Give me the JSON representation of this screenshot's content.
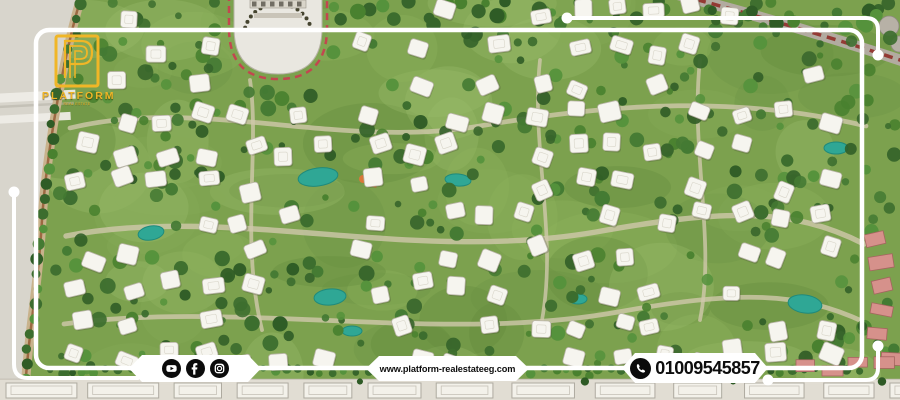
{
  "brand": {
    "name": "PLATFORM",
    "tagline": "REAL ESTATE"
  },
  "footer": {
    "social": {
      "youtube": "YouTube",
      "facebook": "Facebook",
      "instagram": "Instagram"
    },
    "website": {
      "url": "www.platform-realestateeg.com"
    },
    "contact": {
      "phone": "01009545857",
      "icon": "whatsapp"
    }
  },
  "scene": {
    "seed": 11,
    "colors": {
      "base": "#7ca14e",
      "mottle": [
        "#8fb45e",
        "#6a9344",
        "#9dbd6d",
        "#5f8a3c",
        "#86ab57"
      ],
      "trail": "#cfc8ab",
      "tree": [
        "#3c6d2e",
        "#49812f",
        "#2f5c26",
        "#55923c",
        "#447a33",
        "#37652b"
      ],
      "treeDark": "#2e5a25",
      "villaFill": "#f6f5ef",
      "villaStroke": "#b9b5a8",
      "lakeFill": "#2fa795",
      "lakeStroke": "#1f8a7c",
      "stripFill": "#d8d5cc",
      "stripRoad": "#eeece6",
      "borderRoad": "#c8b28c",
      "borderBrown": "#97613a",
      "plazaFill": "#e9e7e0",
      "plazaDash": "#c2474f",
      "roadGray": "#b2aba0",
      "roadRed": "#8f2d28",
      "bottomStrip": "#e1ddd3",
      "bottomBuilding": "#f3f1ea",
      "pink": "#d6918b",
      "pinkStroke": "#a5645f",
      "frame": "#ffffff",
      "gold": "#f0b627"
    },
    "boundary": [
      [
        82,
        0
      ],
      [
        52,
        120
      ],
      [
        42,
        220
      ],
      [
        30,
        320
      ],
      [
        25,
        400
      ]
    ],
    "trails": [
      "M70,128 C200,96 340,150 480,126 C620,102 740,96 866,126",
      "M66,236 C230,204 410,264 596,232 C720,210 790,206 864,244",
      "M64,324 C240,300 440,344 618,312 C740,290 800,292 864,322",
      "M250,80 C260,150 240,240 262,330",
      "M540,60 C530,150 560,240 540,330",
      "M700,60 C690,150 716,240 700,320"
    ],
    "lakes": [
      [
        318,
        177,
        20,
        9,
        -8
      ],
      [
        458,
        180,
        13,
        6,
        5
      ],
      [
        330,
        297,
        16,
        8,
        -5
      ],
      [
        151,
        233,
        13,
        7,
        -10
      ],
      [
        805,
        304,
        17,
        9,
        8
      ],
      [
        836,
        148,
        12,
        6,
        0
      ],
      [
        352,
        331,
        10,
        5,
        0
      ],
      [
        578,
        299,
        9,
        5,
        0
      ]
    ],
    "counts": {
      "mottle": 70,
      "trees": 380,
      "topTrees": 40
    }
  }
}
